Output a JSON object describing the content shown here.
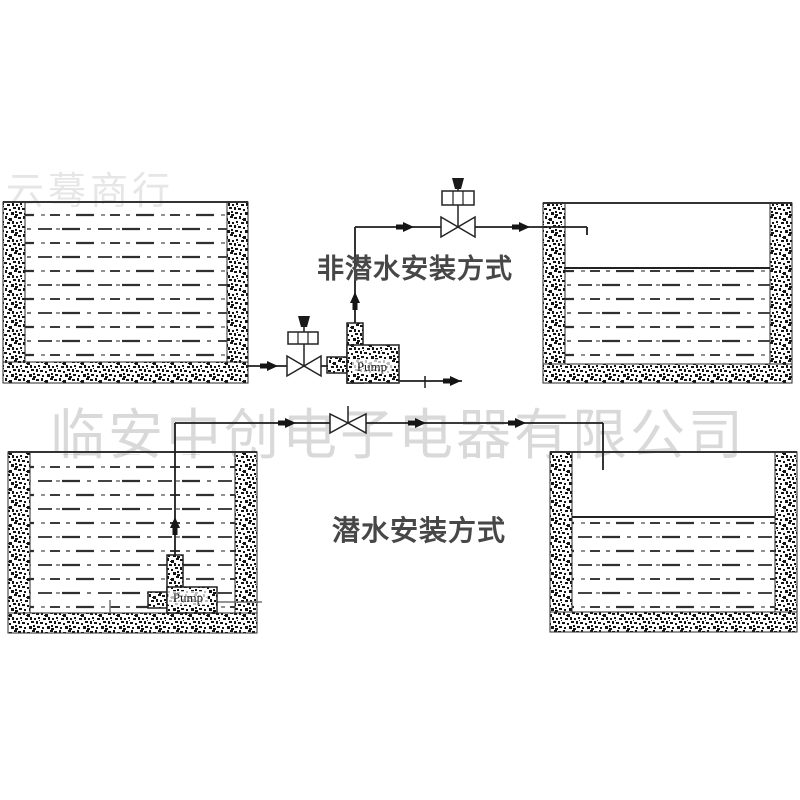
{
  "diagram": {
    "title_top": "非潜水安装方式",
    "title_bottom": "潜水安装方式",
    "pump_label_top": "Pump",
    "pump_label_bottom": "Pump",
    "watermark_main": "临安中创电子电器有限公司",
    "watermark_corner": "云蓦商行",
    "colors": {
      "line": "#1e1e1e",
      "title_text": "#474747",
      "watermark": "#d9d9d9",
      "water_dash": "#333333",
      "stipple": "#141414"
    },
    "icons": [
      "motorized-valve-icon",
      "manual-valve-icon",
      "flow-arrow-icon",
      "pump-icon",
      "tank-icon"
    ]
  }
}
